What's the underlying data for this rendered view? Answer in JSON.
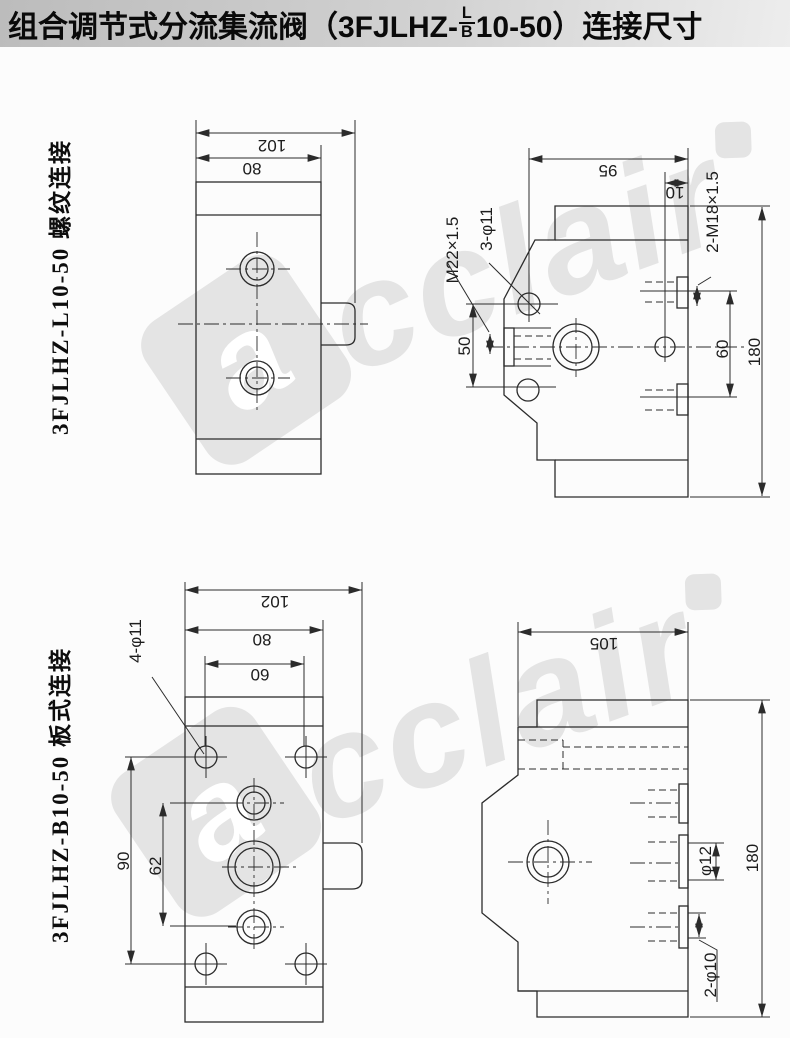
{
  "title": {
    "prefix": "组合调节式分流集流阀（3FJLHZ-",
    "fraction_top": "L",
    "fraction_bottom": "B",
    "suffix": "10-50）连接尺寸"
  },
  "watermark": {
    "brand": "cclair",
    "logo_letter": "a"
  },
  "threaded": {
    "label": "3FJLHZ-L10-50 螺纹连接",
    "front": {
      "dim_total_width": "102",
      "dim_body_width": "80"
    },
    "side": {
      "dim_depth": "95",
      "dim_port_offset": "10",
      "port_left": "M22×1.5",
      "mount_holes": "3-φ11",
      "ports_right": "2-M18×1.5",
      "dim_hole_spacing": "50",
      "dim_port_spacing": "60",
      "dim_height": "180"
    }
  },
  "plate": {
    "label": "3FJLHZ-B10-50 板式连接",
    "front": {
      "dim_total_width": "102",
      "dim_body_width": "80",
      "dim_hole_spacing_h": "60",
      "mount_holes": "4-φ11",
      "dim_hole_spacing_v": "90",
      "dim_port_spacing_v": "62"
    },
    "side": {
      "dim_depth": "105",
      "dim_port_mid": "φ12",
      "dim_height": "180",
      "ports": "2-φ10"
    }
  },
  "colors": {
    "line": "#2b2b2b",
    "title_bg_start": "#bcbcbc",
    "title_bg_end": "#ededed",
    "watermark": "#e4e4e4",
    "page_bg": "#fcfcfc"
  }
}
